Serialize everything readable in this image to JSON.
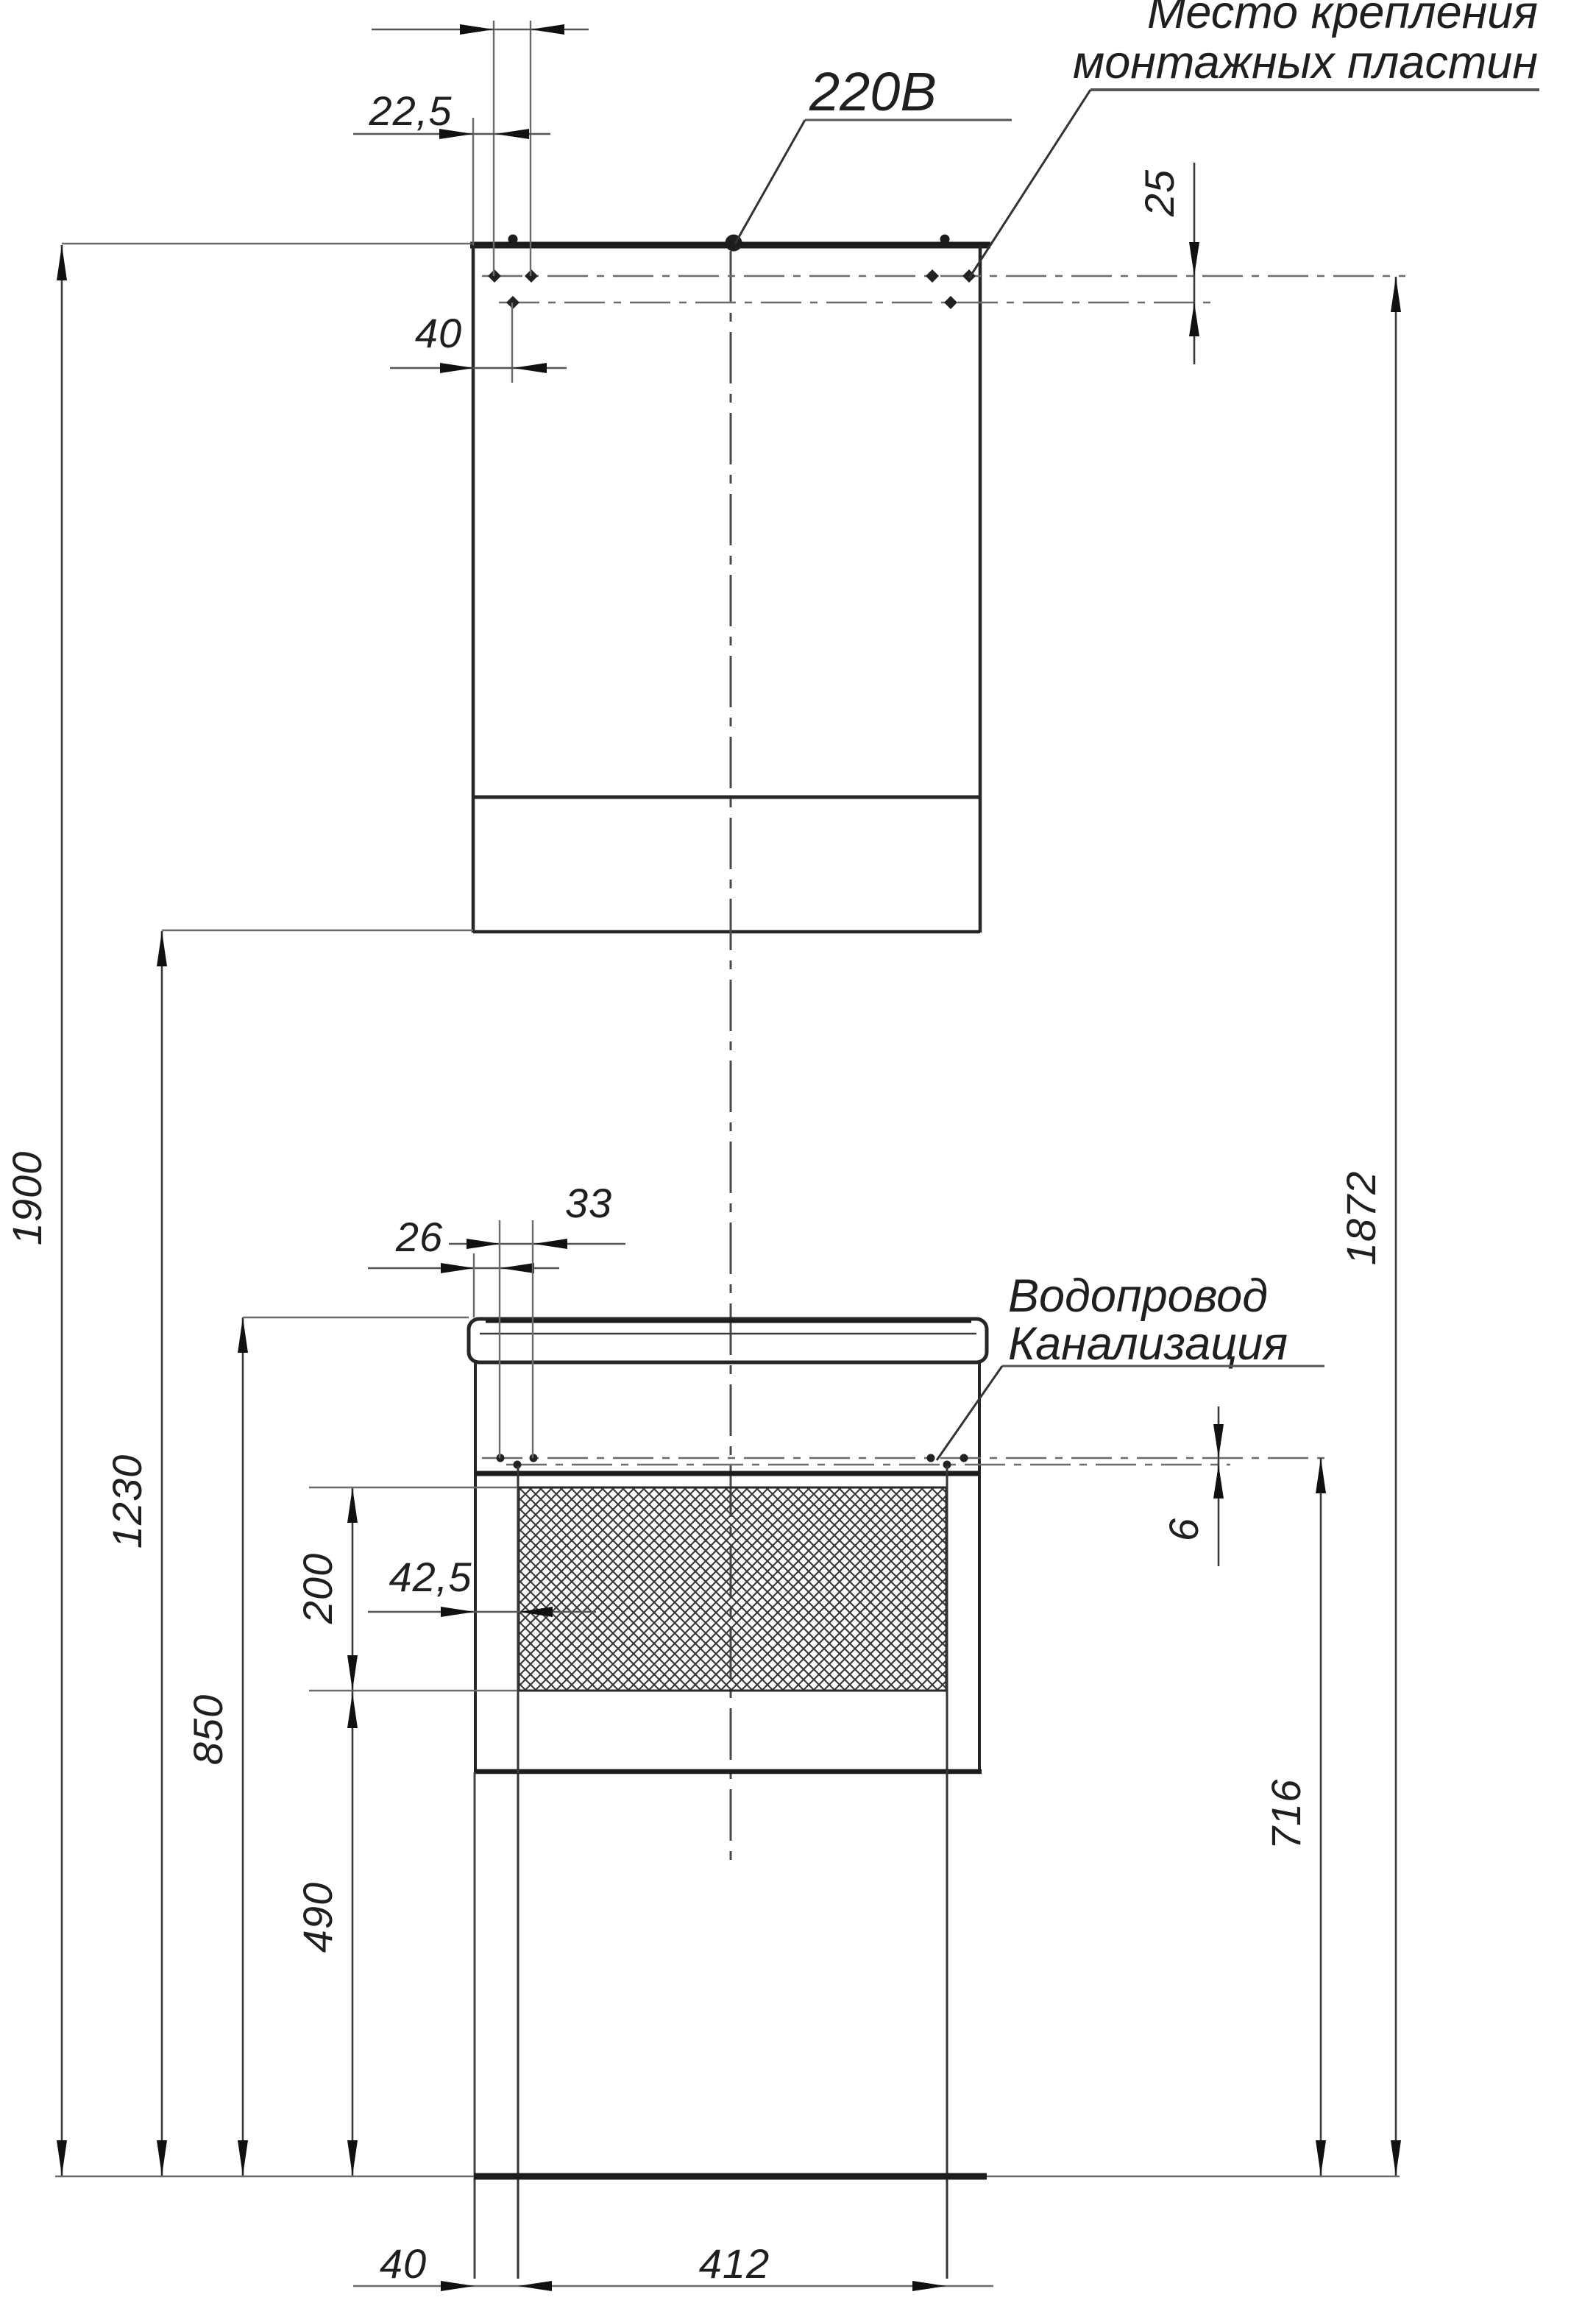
{
  "drawing": {
    "background_color": "#ffffff",
    "main_line_color": "#262626",
    "aux_line_color": "#6b6b6b",
    "annotations": {
      "power_label": "220В",
      "mounting_plates_line1": "Место крепления",
      "mounting_plates_line2": "монтажных пластин",
      "plumbing_line1": "Водопровод",
      "plumbing_line2": "Канализация"
    },
    "dimensions": {
      "overall_height": "1900",
      "mirror_bottom_to_floor": "1230",
      "countertop_to_floor": "850",
      "niche_bottom_to_floor": "490",
      "niche_height": "200",
      "niche_side_offset": "42,5",
      "vanity_hole_edge_offset": "26",
      "vanity_hole_spacing": "33",
      "mirror_hole_edge_offset": "22,5",
      "mirror_lower_hole_offset": "40",
      "mirror_hole_row_gap": "25",
      "vanity_hole_row_gap": "6",
      "vanity_mount_to_floor": "716",
      "mirror_mount_to_floor": "1872",
      "leg_edge_offset": "40",
      "leg_span": "412"
    }
  }
}
